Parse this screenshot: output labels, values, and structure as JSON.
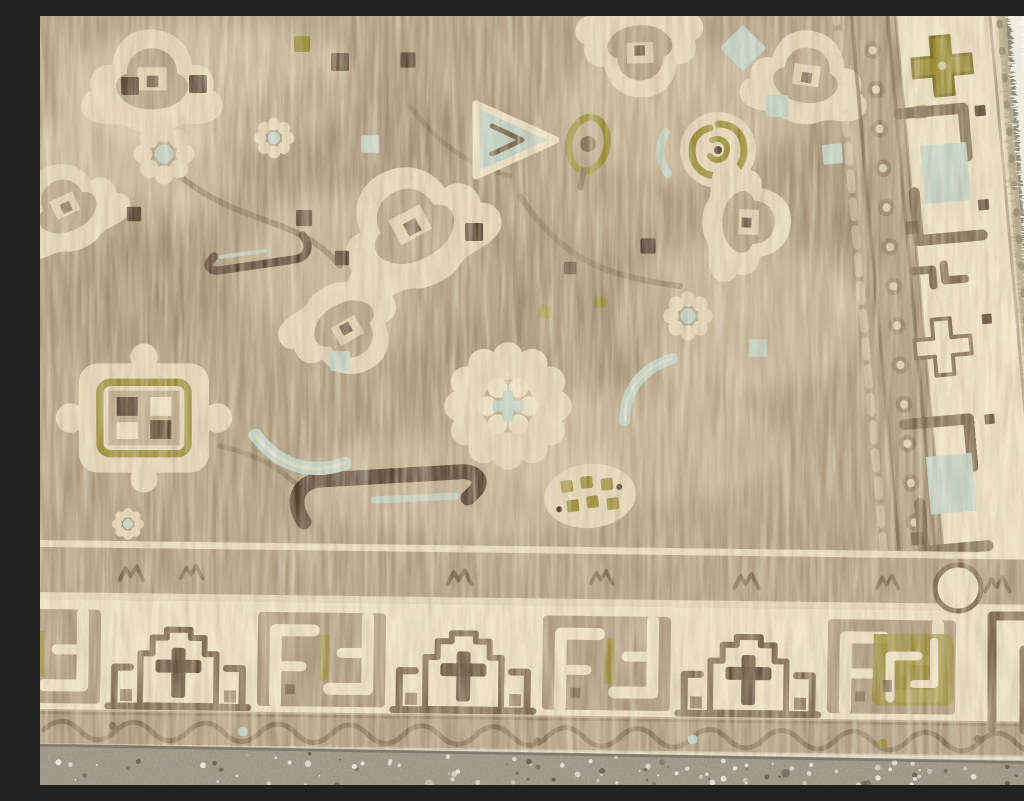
{
  "scene": {
    "subject": "Close-up corner detail of an antique hand-knotted wool rug lying on a speckled terrazzo concrete floor",
    "description": "Overhead photograph of the bottom-right corner of a faded antique Persian-style rug. The taupe-and-cream field is filled with palmettes, rosettes, a window medallion, hooked rings and leaf sprays with pale aqua and olive-green accents. A geometric border with stepped arches, crosses and interlocking key motifs runs along the bottom and right edges, finished with a pale binding cord and a white fringe selvedge. Gray terrazzo floor with white stone chips shows in a wedge at the upper right and a strip along the bottom."
  },
  "palette": {
    "floor_base": "#9c9484",
    "floor_shade": "#878071",
    "floor_speckle_light": "#ece7da",
    "floor_speckle_dark": "#675f50",
    "field_ground": "#ab987e",
    "cream": "#e4d6b7",
    "cream_light": "#eee1c6",
    "taupe": "#a08c72",
    "taupe2": "#ad9a80",
    "brown": "#7a664e",
    "dark_brown": "#53412e",
    "aqua": "#bfd3c7",
    "olive": "#97892f",
    "olive_deep": "#7a701f",
    "binding": "#d2c8af",
    "white": "#f4f0e3",
    "shadow": "#4a443a"
  },
  "rug": {
    "type": "hand-knotted wool rug, corner detail",
    "style": "antique Persian Malayer / Heriz style, sun-faded neutral palette",
    "field_motifs": [
      "palmette",
      "rosette",
      "big-rosette",
      "window-medallion",
      "hooked-swirl-ring",
      "aqua-arrow",
      "olive-bud",
      "olive-dot-cluster",
      "dark-hooked-stem",
      "scattered-squares"
    ],
    "bottom_border_motifs": [
      "stepped-arch-with-cross",
      "interlocking-key-panel",
      "scalloped-vine-guard",
      "chain-guard"
    ],
    "right_border_motifs": [
      "serrated-olive-cross",
      "double-bracket-with-aqua-block",
      "hook-pair",
      "chain-guard"
    ],
    "edge_finish": [
      "pale-binding-cord",
      "white-fringe-selvedge"
    ]
  },
  "floor": {
    "seed": 9,
    "wedge_count": 130,
    "strip_count": 170
  }
}
